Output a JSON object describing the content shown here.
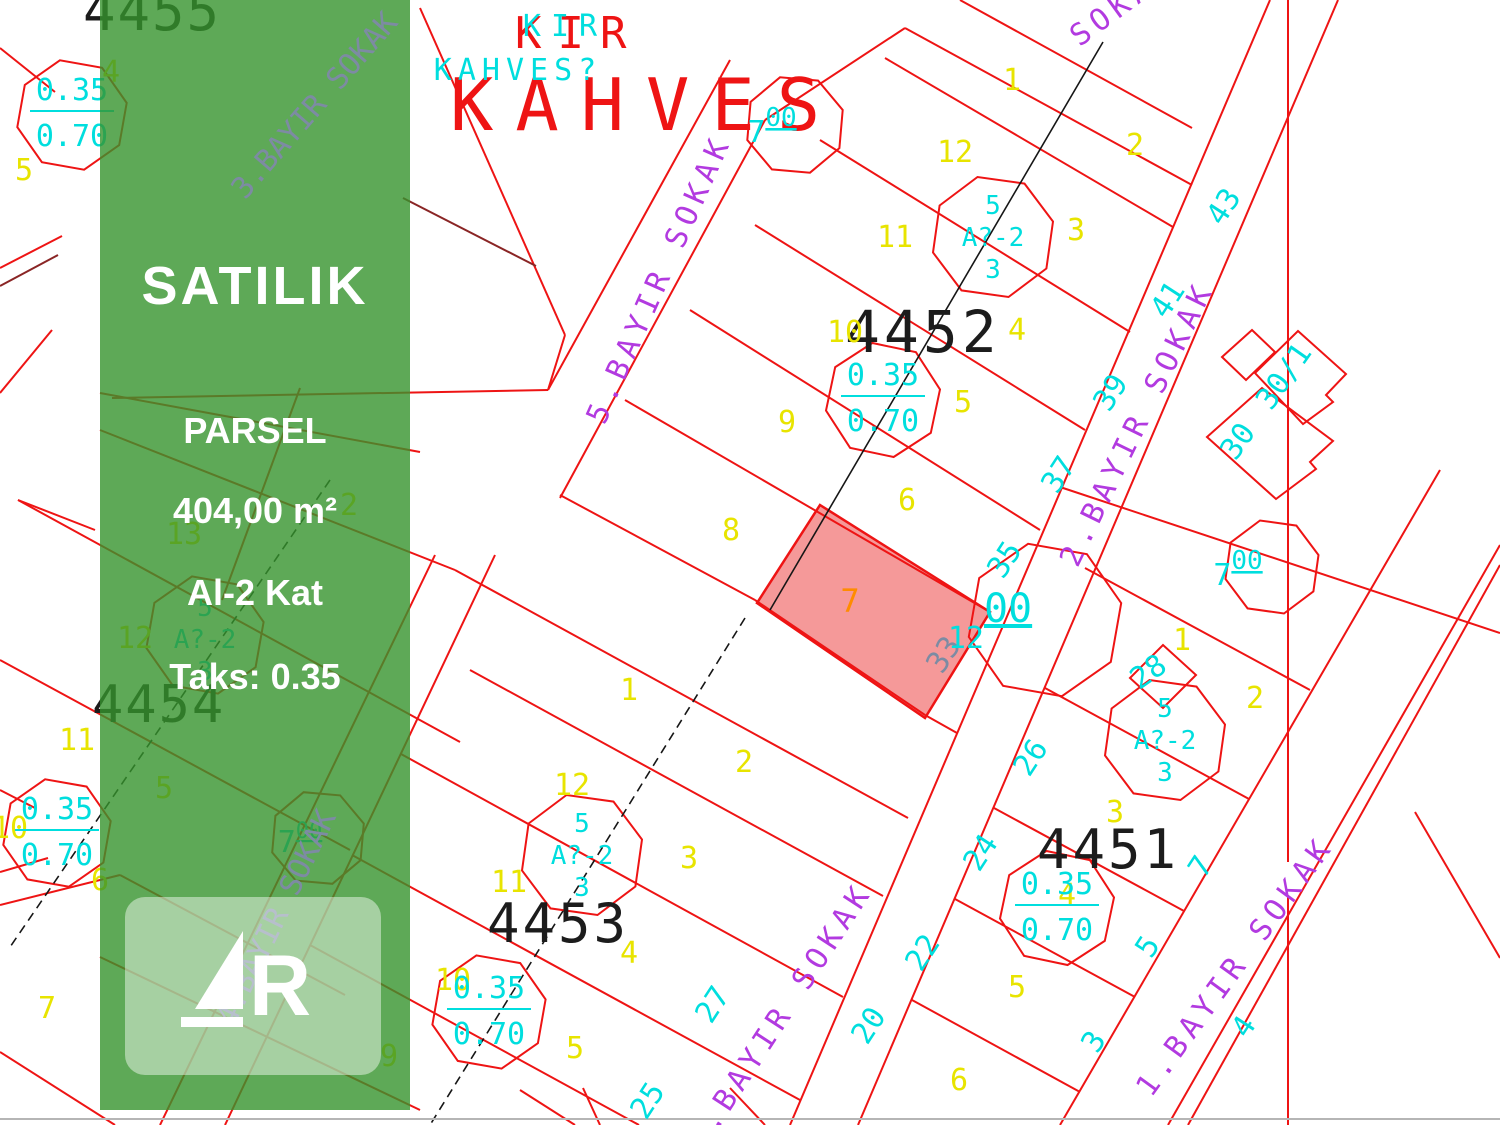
{
  "banner": {
    "title": "SATILIK",
    "parcel_label": "PARSEL",
    "area": "404,00 m²",
    "floors": "Al-2 Kat",
    "taks": "Taks: 0.35",
    "logo_r": "R"
  },
  "map": {
    "block_labels": [
      {
        "t": "4455"
      },
      {
        "t": "4452"
      },
      {
        "t": "4453"
      },
      {
        "t": "4454"
      },
      {
        "t": "4451"
      }
    ],
    "kahvesi": {
      "red1": "KIR",
      "red2": "KAHVES",
      "cyan1": "KIR",
      "cyan2": "KAHVES?"
    },
    "streets": [
      {
        "name": "5.BAYIR SOKAK"
      },
      {
        "name": "2.BAYIR SOKAK"
      },
      {
        "name": "2.BAYIR SOKAK"
      },
      {
        "name": "1.BAYIR SOKAK"
      },
      {
        "name": "SOKAK"
      },
      {
        "name": "3.BAYIR SOKAK"
      },
      {
        "name": "4.BAYIR SOKAK"
      }
    ],
    "highlight_number": "7",
    "ratio_value": {
      "top": "0.35",
      "bottom": "0.70"
    },
    "zone_value": {
      "top": "5",
      "mid": "A?-2",
      "bot": "3"
    },
    "width_values": {
      "w7": "7",
      "w12": "12",
      "sup": "00"
    },
    "parcel_numbers": [
      {
        "t": "1"
      },
      {
        "t": "12"
      },
      {
        "t": "11"
      },
      {
        "t": "10"
      },
      {
        "t": "9"
      },
      {
        "t": "8"
      },
      {
        "t": "2"
      },
      {
        "t": "3"
      },
      {
        "t": "4"
      },
      {
        "t": "5"
      },
      {
        "t": "6"
      },
      {
        "t": "1"
      },
      {
        "t": "12"
      },
      {
        "t": "2"
      },
      {
        "t": "11"
      },
      {
        "t": "3"
      },
      {
        "t": "4"
      },
      {
        "t": "10"
      },
      {
        "t": "5"
      },
      {
        "t": "1"
      },
      {
        "t": "2"
      },
      {
        "t": "3"
      },
      {
        "t": "4"
      },
      {
        "t": "5"
      },
      {
        "t": "6"
      },
      {
        "t": "11"
      },
      {
        "t": "10"
      },
      {
        "t": "5"
      },
      {
        "t": "7"
      },
      {
        "t": "12"
      },
      {
        "t": "5"
      },
      {
        "t": "2"
      },
      {
        "t": "13"
      },
      {
        "t": "4"
      },
      {
        "t": "6"
      },
      {
        "t": "9"
      }
    ],
    "address_numbers": [
      {
        "t": "43"
      },
      {
        "t": "41"
      },
      {
        "t": "39"
      },
      {
        "t": "37"
      },
      {
        "t": "35"
      },
      {
        "t": "33"
      },
      {
        "t": "26"
      },
      {
        "t": "28"
      },
      {
        "t": "24"
      },
      {
        "t": "22"
      },
      {
        "t": "20"
      },
      {
        "t": "27"
      },
      {
        "t": "25"
      },
      {
        "t": "7"
      },
      {
        "t": "5"
      },
      {
        "t": "3"
      },
      {
        "t": "4"
      },
      {
        "t": "30/1"
      },
      {
        "t": "30"
      }
    ]
  },
  "colors": {
    "banner_green": "#369430",
    "line_red": "#ee1414",
    "map_cyan": "#00dede",
    "map_yellow": "#e8e400",
    "street_purple": "#b23ae0",
    "highlight_pink": "#f38080"
  }
}
